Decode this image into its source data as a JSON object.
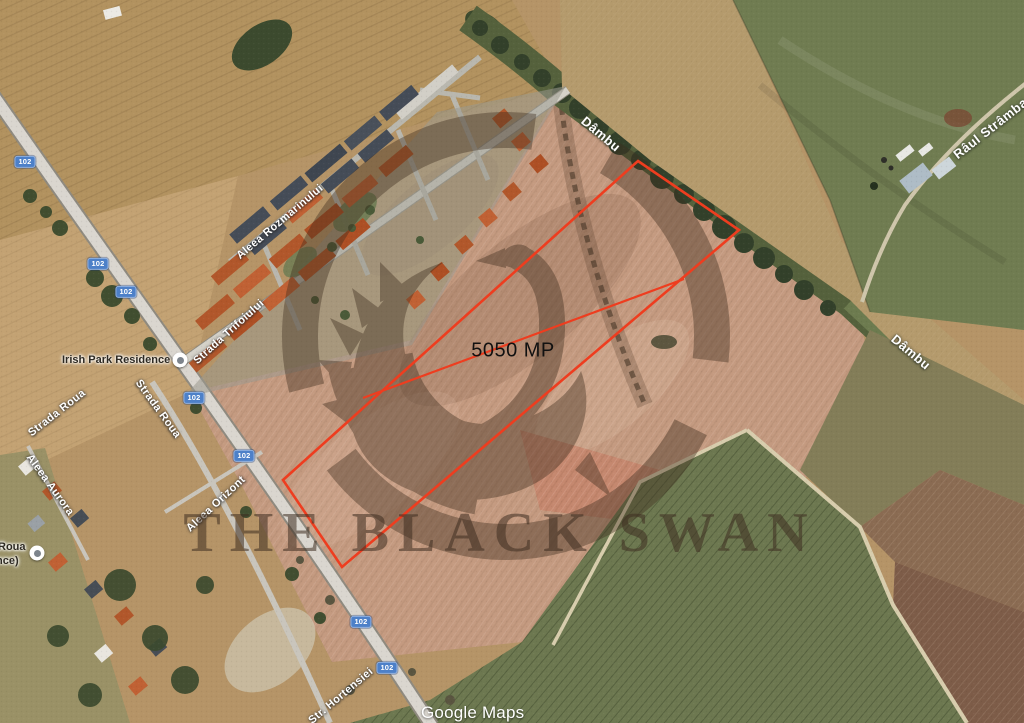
{
  "plot": {
    "area_label": "5050 MP"
  },
  "watermark": {
    "title": "THE BLACK SWAN"
  },
  "attribution": {
    "label": "Google Maps"
  },
  "road_badge": {
    "number": "102"
  },
  "colors": {
    "plot_outline": "#ee3d1f",
    "road_badge_bg": "#4d80c8"
  },
  "streets": [
    {
      "name": "Aleea Rozmarinului"
    },
    {
      "name": "Strada Trifoiului"
    },
    {
      "name": "Strada Roua"
    },
    {
      "name": "Strada Roua"
    },
    {
      "name": "Aleea Aurora"
    },
    {
      "name": "Aleea Orizont"
    },
    {
      "name": "Str. Hortensiei"
    }
  ],
  "waterways": [
    {
      "name": "Dâmbu"
    },
    {
      "name": "Dâmbu"
    },
    {
      "name": "Râul Strâmba,"
    }
  ],
  "pois": [
    {
      "name": "Irish Park Residence"
    },
    {
      "name_line1": "Roua",
      "name_line2": "nce)"
    }
  ]
}
